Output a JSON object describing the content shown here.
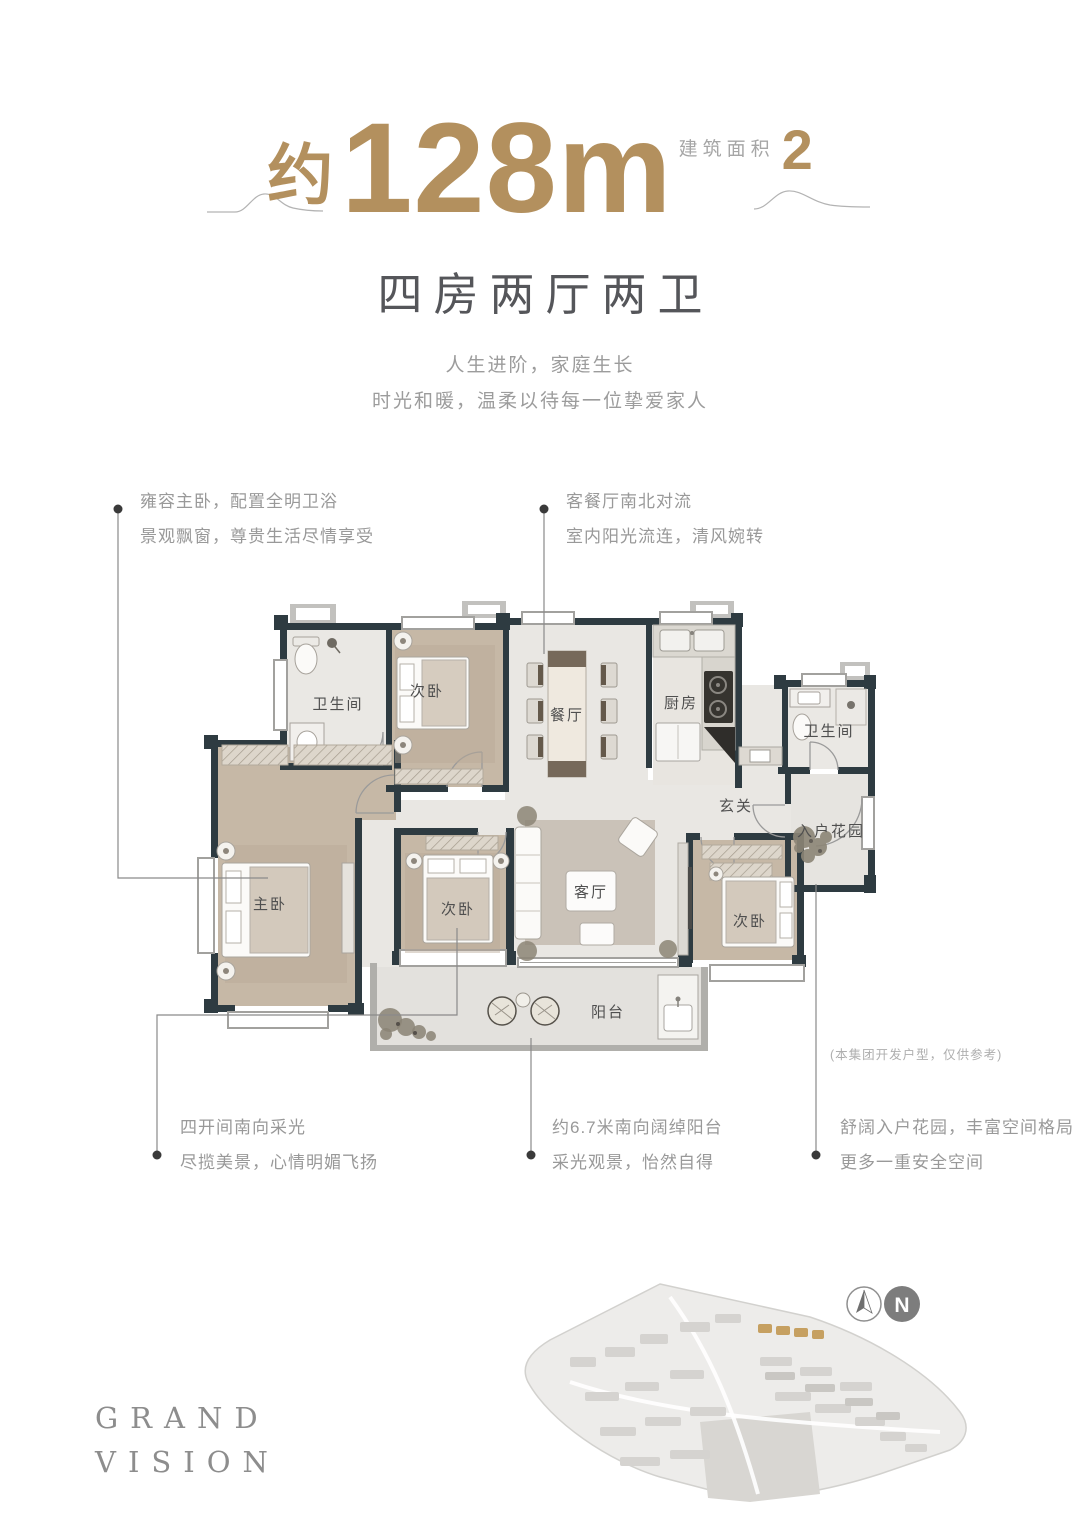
{
  "header": {
    "area_prefix": "约",
    "area_value": "128",
    "area_unit": "m",
    "area_exp": "2",
    "area_label": "建筑面积",
    "subtitle": "四房两厅两卫",
    "tagline1": "人生进阶，家庭生长",
    "tagline2": "时光和暖，温柔以待每一位挚爱家人"
  },
  "callouts": {
    "top_left": {
      "line1": "雍容主卧，配置全明卫浴",
      "line2": "景观飘窗，尊贵生活尽情享受"
    },
    "top_right": {
      "line1": "客餐厅南北对流",
      "line2": "室内阳光流连，清风婉转"
    },
    "bottom_left": {
      "line1": "四开间南向采光",
      "line2": "尽揽美景，心情明媚飞扬"
    },
    "bottom_middle": {
      "line1": "约6.7米南向阔绰阳台",
      "line2": "采光观景，怡然自得"
    },
    "bottom_right": {
      "line1": "舒阔入户花园，丰富空间格局",
      "line2": "更多一重安全空间"
    }
  },
  "floorplan": {
    "rooms": {
      "bath_top": "卫生间",
      "bed_top": "次卧",
      "dining": "餐厅",
      "kitchen": "厨房",
      "bath_right": "卫生间",
      "foyer": "玄关",
      "entry_garden": "入户花园",
      "master": "主卧",
      "bed_middle": "次卧",
      "living": "客厅",
      "bed_right": "次卧",
      "balcony": "阳台"
    },
    "disclaimer": "(本集团开发户型，仅供参考)"
  },
  "footer": {
    "brand_line1": "GRAND",
    "brand_line2": "VISION",
    "compass_n": "N"
  },
  "colors": {
    "gold": "#b3905e",
    "subtitle_gray": "#55565a",
    "muted_gray": "#9b9b9b",
    "wall_dark": "#2e3b41"
  }
}
